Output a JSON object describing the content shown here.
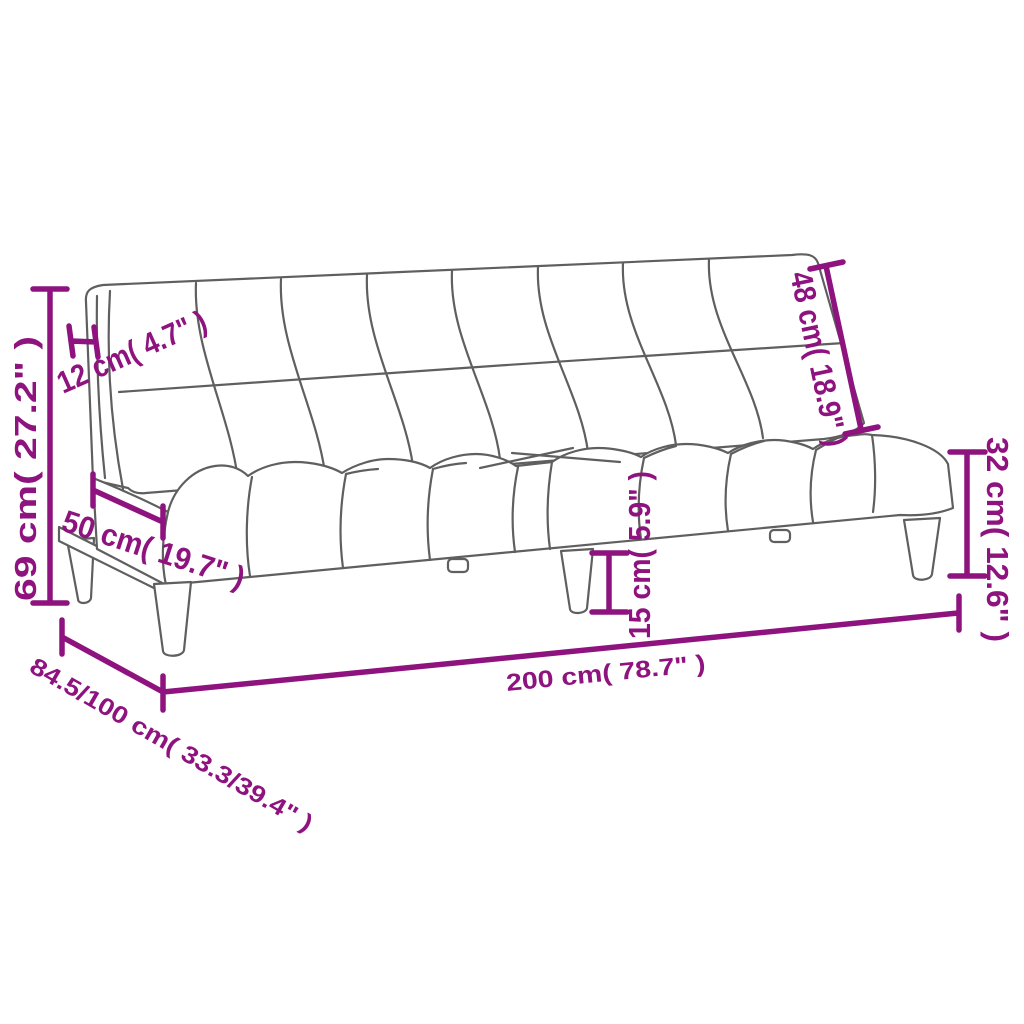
{
  "diagram": {
    "type": "product-dimension-diagram",
    "subject": "sofa-bed line drawing with measurement annotations",
    "dimensions": {
      "overall_height": "69 cm( 27.2\" )",
      "backrest_thickness": "12 cm( 4.7\" )",
      "seat_depth": "50 cm( 19.7\" )",
      "backrest_height": "48 cm( 18.9\" )",
      "seat_height": "32 cm( 12.6\" )",
      "leg_height": "15 cm( 5.9\" )",
      "overall_width": "200 cm( 78.7\" )",
      "overall_depth": "84.5/100 cm( 33.3/39.4\" )"
    },
    "colors": {
      "dimension_accent": "#8E137F",
      "line_art": "#5F5F5F",
      "background": "#FFFFFF"
    }
  }
}
